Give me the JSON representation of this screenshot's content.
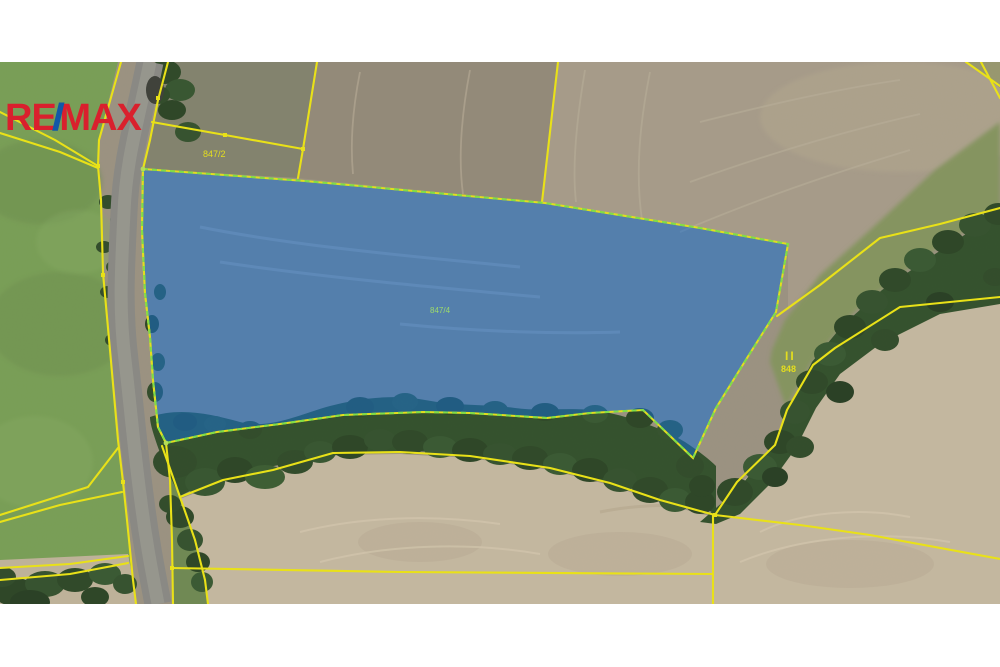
{
  "branding": {
    "re": "RE",
    "slash": "/",
    "max": "MAX"
  },
  "map": {
    "labels": {
      "parcel_above": {
        "text": "847/2",
        "color": "#e9e31a"
      },
      "parcel_highlighted": {
        "text": "847/4",
        "color": "#9fe06b"
      },
      "parcel_forest": {
        "text": "848",
        "color": "#e9e31a"
      },
      "forest_symbol": {
        "text": "II",
        "color": "#e9e31a"
      }
    },
    "colors": {
      "boundary_yellow": "#efe713",
      "highlight_fill": "#0f6ed7",
      "highlight_outline": "#7fe345",
      "logo_red": "#d9202d",
      "logo_blue": "#1258a7"
    }
  }
}
